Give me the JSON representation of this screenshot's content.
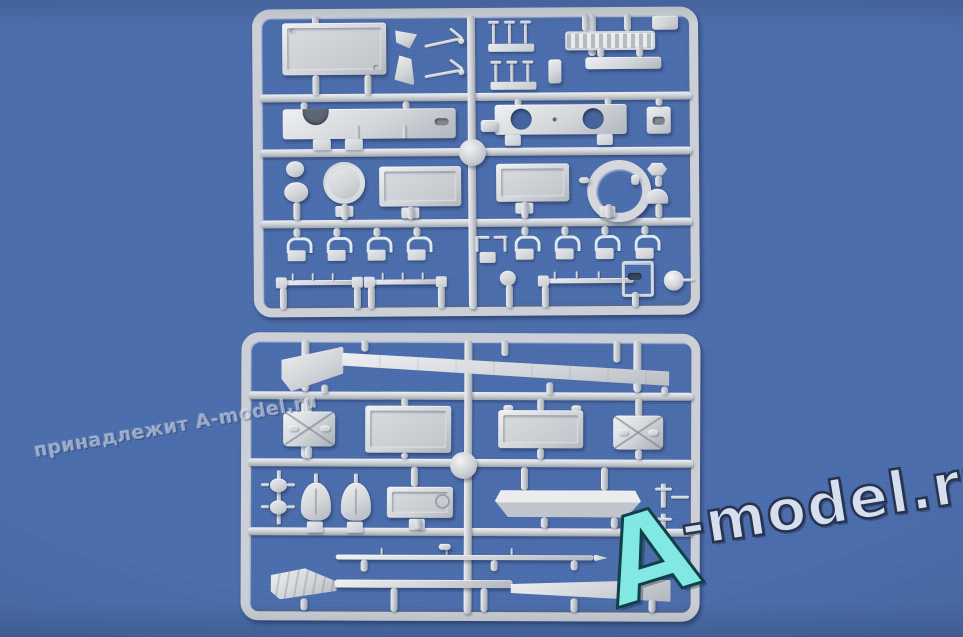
{
  "image": {
    "background_color": "#4a6dac",
    "plastic_color": "#d3d6da"
  },
  "watermarks": {
    "brand": {
      "letter_a": "A",
      "rest": "-model.ru",
      "a_fill": "#82e8e4",
      "rest_fill": "#d6dfee",
      "outline": "#273350"
    },
    "ownership": {
      "text": "принадлежит A-model.ru"
    }
  },
  "sprues": [
    {
      "id": "top-sprue",
      "parts": [
        "roof-panel",
        "wedge-bracket",
        "tow-rod",
        "pin-post-cluster",
        "engine-grille",
        "support-bar",
        "notched-bulkhead",
        "twin-hole-plate",
        "stowage-box",
        "round-hatch",
        "rect-hatch",
        "hatch-ring",
        "hex-cap",
        "dome-cap",
        "grab-handle",
        "mounting-rail",
        "framed-bracket",
        "ball-part"
      ]
    },
    {
      "id": "bottom-sprue",
      "parts": [
        "side-skirt",
        "x-braced-hatch",
        "bolted-hatch",
        "wide-panel",
        "pulley-column",
        "teardrop-shield",
        "access-panel",
        "hull-side-panel",
        "t-bracket",
        "tie-rod",
        "lower-skirt-blade"
      ]
    }
  ]
}
